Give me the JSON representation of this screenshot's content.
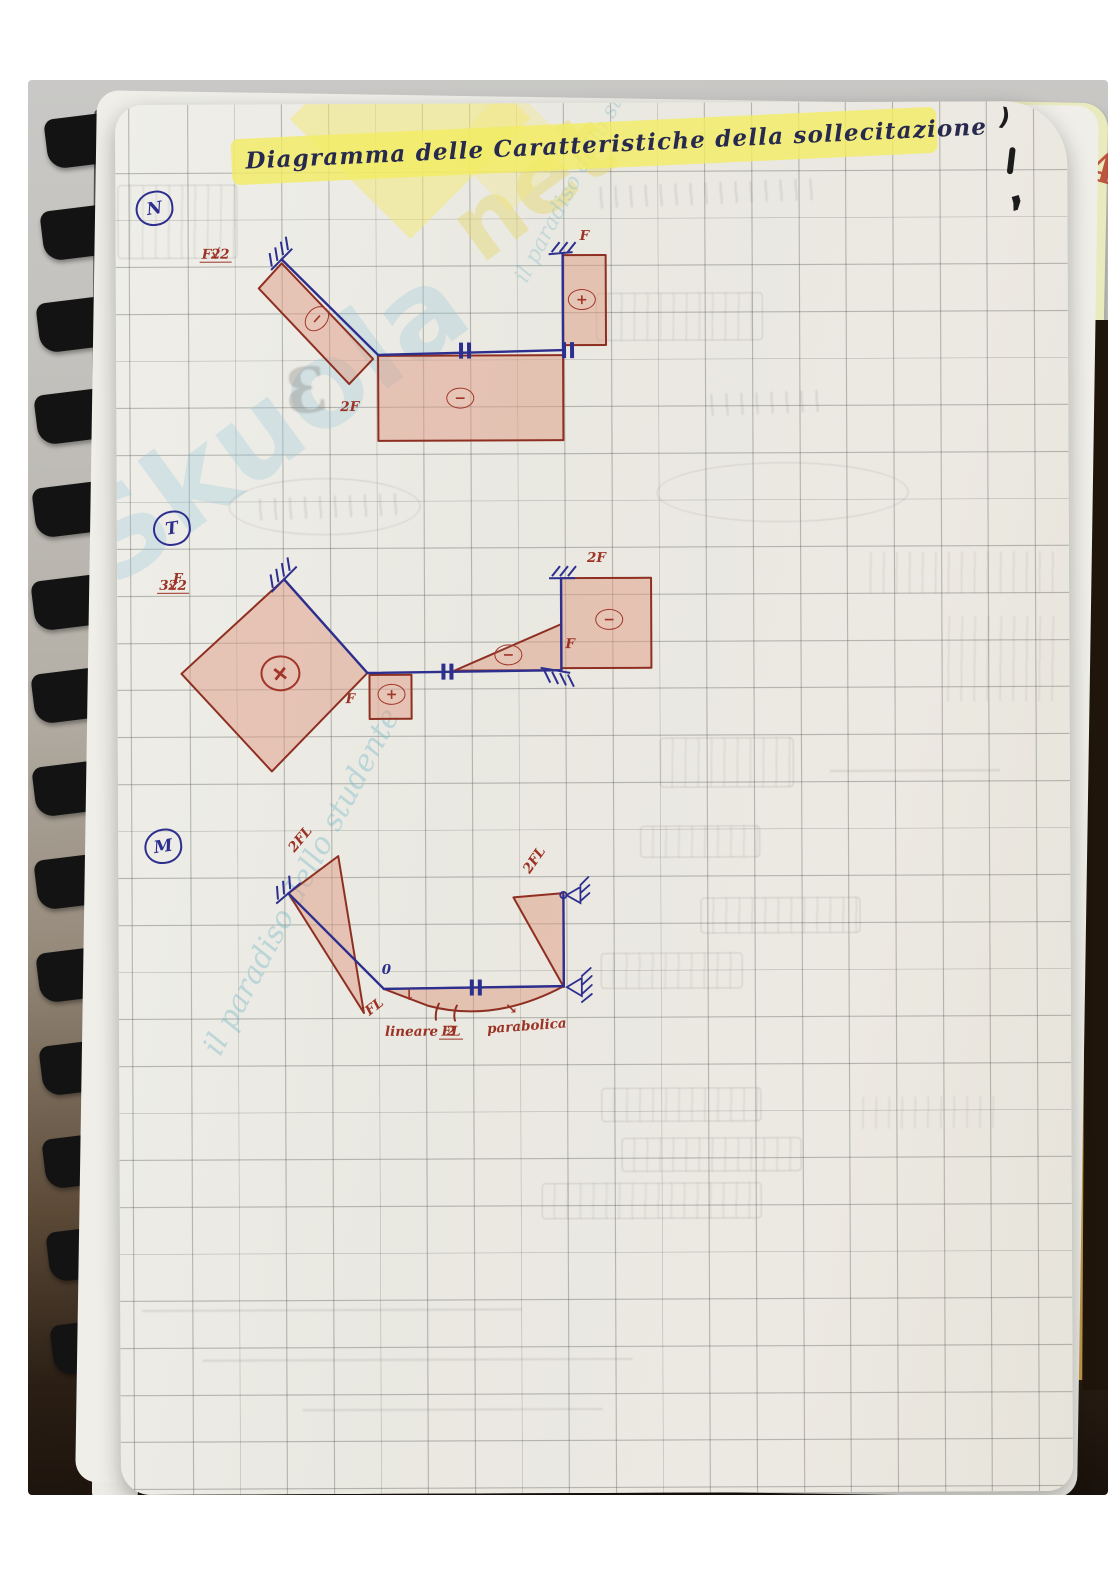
{
  "title": {
    "text": "Diagramma delle Caratteristiche della sollecitazione"
  },
  "neighbor_page": {
    "number": "141"
  },
  "pen_marks": {
    "m1": ")",
    "m2": "1",
    "m3": ","
  },
  "watermark": {
    "word_main": "Skuola",
    "word_accent": "net",
    "tagline": "il paradiso dello studente"
  },
  "colors": {
    "pen_blue": "#2d2f8f",
    "pencil_red": "#9c3224",
    "highlighter": "#f3ec62",
    "shade_pink": "#e09c84",
    "binding_black": "#131313",
    "neighbor_page_yellow": "#e9eabd"
  },
  "diagrams": {
    "n": {
      "label": "N",
      "diag_value_num": "F√2",
      "diag_value_den": "2",
      "diag_sign": "−",
      "bottom_value": "2F",
      "bottom_sign": "−",
      "right_value": "F",
      "right_sign": "+"
    },
    "t": {
      "label": "T",
      "diamond_value_num": "3√2",
      "diamond_value_den": "2",
      "diamond_value_suffix": "F",
      "diamond_sign": "+",
      "square_value": "F",
      "square_sign": "+",
      "triangle_value": "F",
      "triangle_sign": "−",
      "square2_value": "2F",
      "square2_sign": "−"
    },
    "m": {
      "label": "M",
      "left_peak_value": "2FL",
      "corner_value": "FL",
      "zero_value": "0",
      "down_arrow": "↓",
      "linear_label": "lineare",
      "mid_value_num": "FL",
      "mid_value_den": "2",
      "parabola_label": "parabolica",
      "parabola_arrow": "↘",
      "right_peak_value": "2FL"
    }
  }
}
